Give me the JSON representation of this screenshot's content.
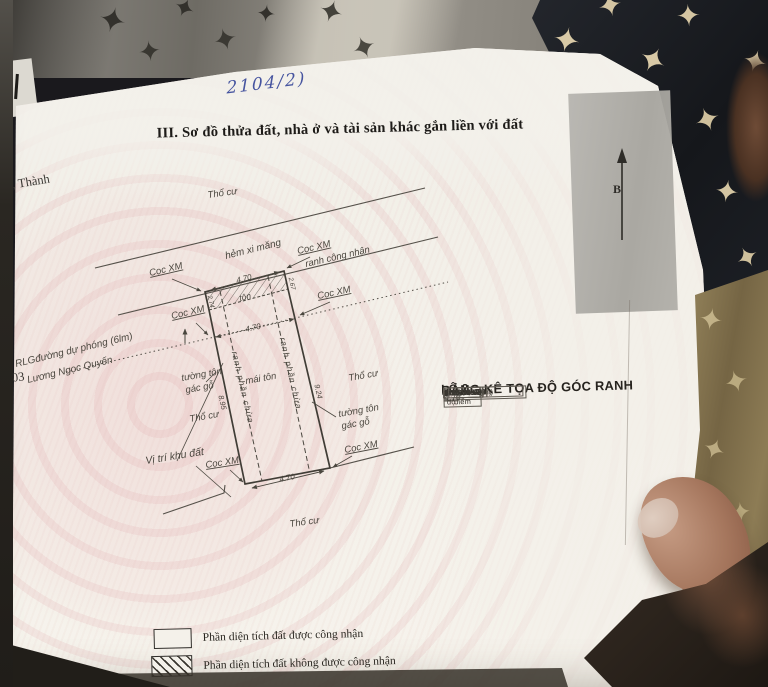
{
  "page": {
    "handwritten_note": "2104/2)",
    "edge_text_top": "ạnh, Thành",
    "edge_text_bottom": "/2003",
    "title": "III. Sơ đồ thửa đất, nhà ở và tài sản khác gắn liền với đất",
    "north_label": "B"
  },
  "diagram": {
    "tho_cu": "Thổ cư",
    "coc_xm": "Cọc XM",
    "hem_xi_mang": "hẻm xi măng",
    "ranh_cong_nhan": "ranh công nhận",
    "duong_du_phong": "RLGđường dự phóng (6lm)",
    "street": "Lương Ngọc Quyến",
    "tuong_ton_1": "tường tôn",
    "tuong_ton_2": "gác gỗ",
    "mai_ton": "mái tôn",
    "ton": "tôn",
    "vi_tri_khu_dat": "Vị trí khu đất",
    "ranh_phan_chua": "ranh phần chừa",
    "dim_top": "4.70",
    "dim_mid": "4.70",
    "dim_bottom": "4.70",
    "dim_left": "8.95",
    "dim_right": "9.24",
    "dim_tl": "2.74",
    "dim_tr": "2.67"
  },
  "table": {
    "title_line1": "BẢNG KÊ TỌA ĐỘ GÓC RANH",
    "title_line2": "LÔ 2",
    "col_point_1": "Số hiệu",
    "col_point_2": "điểm",
    "col_coords": "Tọa độ",
    "col_x": "X(m)",
    "col_y": "Y(m)",
    "col_edge": "Cạnh",
    "rows": [
      {
        "id": "1",
        "x": "1196958.20",
        "y": "603202.38"
      },
      {
        "id": "2",
        "x": "1196959.26",
        "y": "603206.96"
      },
      {
        "id": "3",
        "x": "1196956.64",
        "y": "603207.48"
      },
      {
        "id": "4",
        "x": "1196947.59",
        "y": "603209.31"
      },
      {
        "id": "5",
        "x": "1196946.74",
        "y": "603204.69"
      },
      {
        "id": "6",
        "x": "1196955.52",
        "y": "603202.92"
      },
      {
        "id": "1",
        "x": "1196958.20",
        "y": "603202.38"
      }
    ],
    "edges": [
      "4.70",
      "2.67",
      "9.24",
      "4.70",
      "8.95",
      "2.74"
    ]
  },
  "legend": {
    "recognized": "Phần diện tích đất được công nhận",
    "not_recognized": "Phần diện tích đất không được công nhận"
  }
}
